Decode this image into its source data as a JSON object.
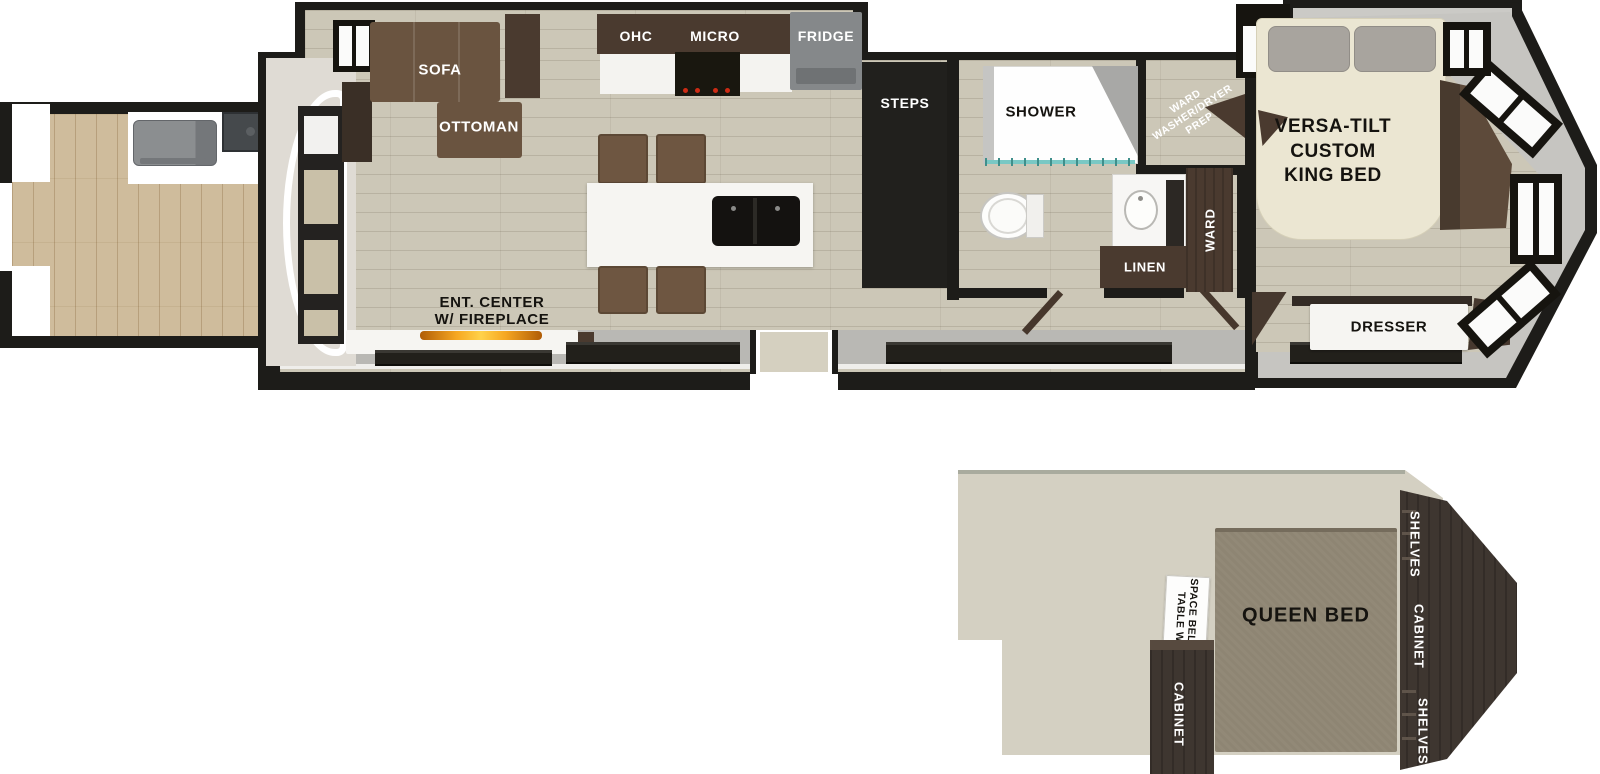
{
  "colors": {
    "wall": "#1d1c19",
    "interior_floor": "#ccc7b7",
    "deck_wood": "#cfbc9c",
    "chassis_gray": "#b9b8b4",
    "sofa_brown": "#6a5440",
    "cabinet_brown": "#4a3a2f",
    "loft_furniture": "#3e3630",
    "fridge_gray": "#85888a",
    "king_bed_cream": "#ebe6d2",
    "queen_bed_taupe": "#8e8573",
    "loft_floor": "#d4d0c2",
    "pillow_gray": "#a8a49e",
    "flame_orange": "#e8860f",
    "shower_glass_teal": "#79c8c4"
  },
  "main_floor": {
    "living": {
      "sofa": "SOFA",
      "ottoman": "OTTOMAN",
      "ent_center_line1": "ENT. CENTER",
      "ent_center_line2": "W/ FIREPLACE"
    },
    "kitchen": {
      "ohc": "OHC",
      "micro": "MICRO",
      "fridge": "FRIDGE"
    },
    "entry": {
      "steps": "STEPS"
    },
    "bath": {
      "shower": "SHOWER",
      "linen": "LINEN"
    },
    "utility_closet": {
      "line1": "WARD",
      "line2": "WASHER/DRYER",
      "line3": "PREP"
    },
    "bedroom": {
      "bed_line1": "VERSA-TILT",
      "bed_line2": "CUSTOM",
      "bed_line3": "KING BED",
      "ward": "WARD",
      "dresser": "DRESSER"
    }
  },
  "loft": {
    "queen_bed": "QUEEN BED",
    "table_line1": "TABLE W/",
    "table_line2": "SPACE BELOW",
    "cabinet_left": "CABINET",
    "shelves_top": "SHELVES",
    "cabinet_right": "CABINET",
    "shelves_bottom": "SHELVES"
  }
}
